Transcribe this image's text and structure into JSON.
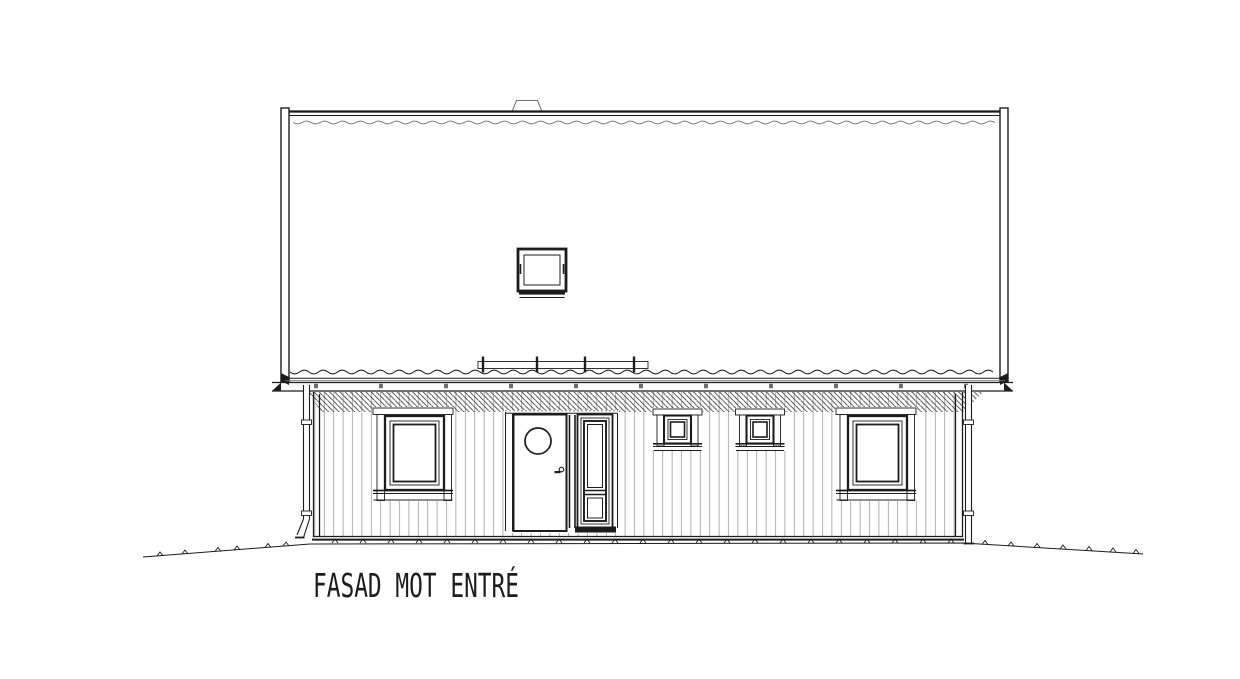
{
  "drawing": {
    "title": "FASAD MOT ENTRÉ"
  },
  "colors": {
    "line": "#1c1c1c",
    "line-light": "#6f6f6f",
    "hatch": "#3d3d3d",
    "siding": "#8d8d8d",
    "bg": "#ffffff"
  }
}
